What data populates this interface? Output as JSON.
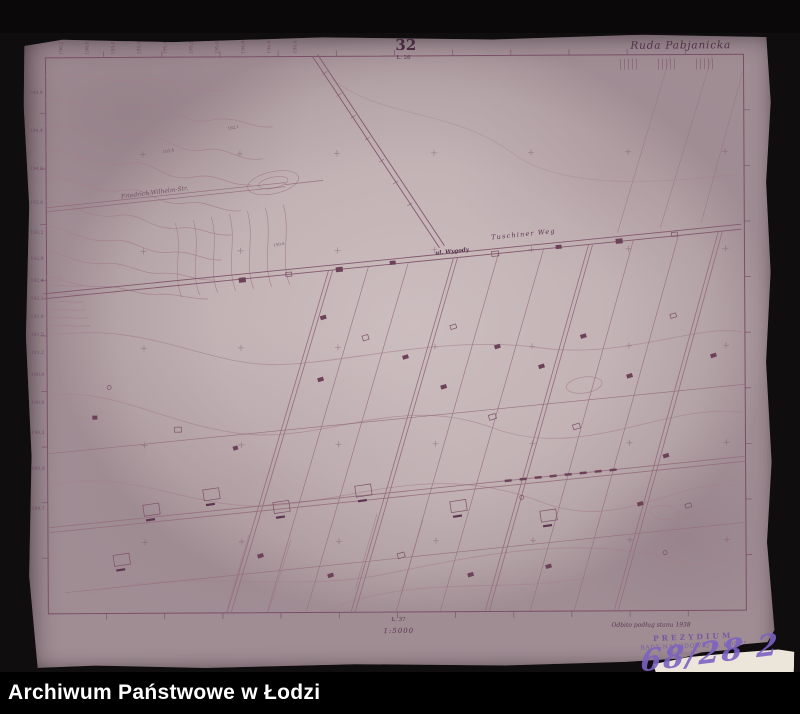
{
  "archive_bar": {
    "label": "Archiwum Państwowe w Łodzi"
  },
  "sheet": {
    "number": "32",
    "code_top": "Ł. 26",
    "code_bottom": "Ł. 37",
    "scale": "1:5000",
    "region": "Ruda Pabjanicka",
    "edition_note": "Odbito podług stanu 1938",
    "handwritten_ref": "68/28 2",
    "stamp": {
      "line1": "PREZYDIUM",
      "line2": "RADY NARODOWEJ m. ŁODZI",
      "line3": "Wydział Geodezji"
    },
    "streets": {
      "friedrich_wilhelm": "Friedrich-Wilhelm-Str.",
      "tuschiner_weg": "Tuschiner Weg",
      "wygody": "ul. Wygody"
    },
    "colors": {
      "ink": "#7a4f66",
      "paper": "#c3b3b5",
      "stamp": "#7050a0",
      "handwriting": "#7c62c2"
    },
    "spot_heights": [
      "193,4",
      "192,1",
      "190,6"
    ],
    "left_elevations": [
      "194,8",
      "194,4",
      "194,0",
      "193,6",
      "193,2",
      "192,8",
      "192,4",
      "192,1",
      "191,8",
      "191,5",
      "191,2",
      "190,9",
      "190,6",
      "190,3",
      "190,0",
      "189,7"
    ],
    "top_elevations": [
      "196,2",
      "196,0",
      "195,8",
      "195,6",
      "195,4",
      "195,2",
      "195,0",
      "194,8",
      "194,6",
      "194,4"
    ]
  }
}
